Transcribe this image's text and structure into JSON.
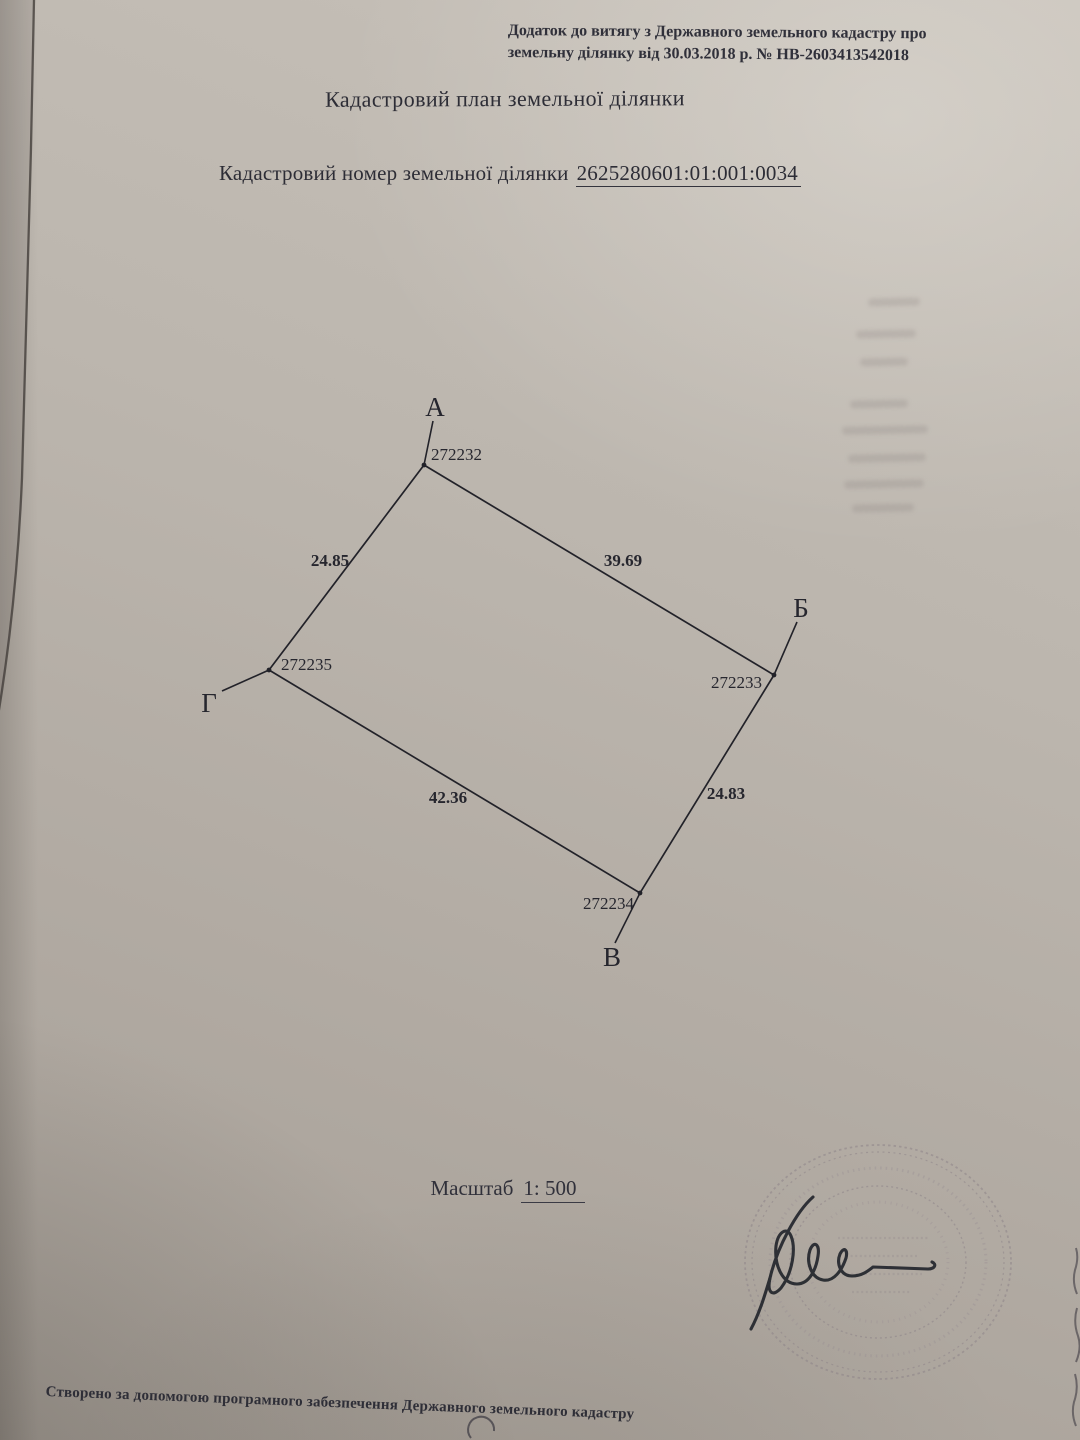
{
  "page": {
    "header_line1": "Додаток до витягу з Державного земельного кадастру про",
    "header_line2": "земельну ділянку від 30.03.2018 р. № НВ-2603413542018",
    "title": "Кадастровий план земельної ділянки",
    "cadastral_label": "Кадастровий номер земельної ділянки",
    "cadastral_number": "2625280601:01:001:0034",
    "scale_label": "Масштаб",
    "scale_value": "1: 500",
    "footer": "Створено за допомогою програмного забезпечення Державного земельного кадастру"
  },
  "plan": {
    "vertices": [
      {
        "label": "А",
        "point_number": "272232"
      },
      {
        "label": "Б",
        "point_number": "272233"
      },
      {
        "label": "В",
        "point_number": "272234"
      },
      {
        "label": "Г",
        "point_number": "272235"
      }
    ],
    "side_lengths": {
      "ga": "24.85",
      "ab": "39.69",
      "bv": "24.83",
      "vg": "42.36"
    }
  },
  "colors": {
    "ink": "#26262e",
    "paper_light": "#c7c1b9",
    "paper_dark": "#a59e96",
    "stamp": "#8b8187",
    "signature_ink": "#23262c"
  }
}
